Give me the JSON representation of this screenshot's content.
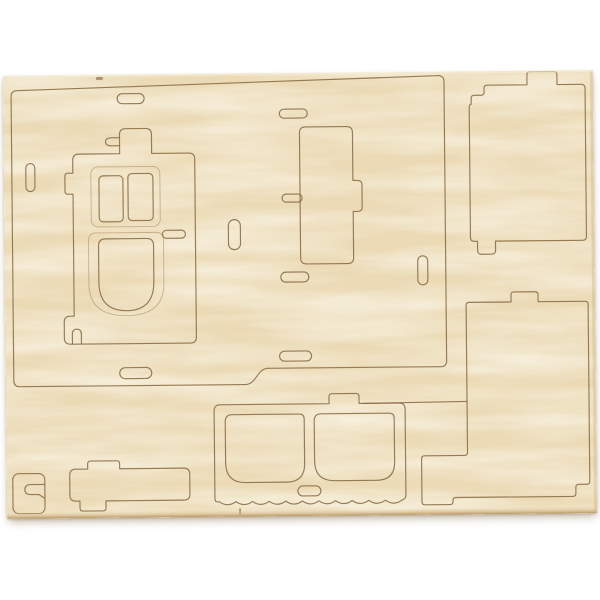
{
  "meta": {
    "description": "Product photo of a light birch plywood laser-cut sheet for a 3D wooden model kit. The sheet lies on a white background, slightly rotated, with pre-cut push-out pieces still in place: a large side-wall panel containing a door piece with two small windows and an arched lower window, a vertical support piece, two large rectangular wall panels with interlocking tabs on the right, a front panel with two rounded windows and a scalloped lower edge, and small connector pieces at the bottom left. Numerous pill-shaped slots are cut through the panels.",
    "object_count_pieces": 9
  },
  "palette": {
    "background": "#ffffff",
    "wood_base": "#ebdab5",
    "wood_light": "#f7eed7",
    "wood_dark": "#dfc89e",
    "cut_line": "#8a6b42",
    "engrave_line": "#a88d60",
    "sheet_edge_dark": "#b5905c",
    "sheet_edge_soft": "#d3b789",
    "shadow": "rgba(140,118,85,0.55)"
  },
  "sheet": {
    "x": 5,
    "y": 73,
    "width": 590,
    "height": 443,
    "rotation_deg": -0.55,
    "shapes": [
      {
        "name": "cut-left-wall-panel",
        "type": "path",
        "cls": "cut",
        "d": "M14,311 Q8,311 8,305 L8,21 Q8,15 14,15 L433,4 Q441,3 441,10 L441,289 Q441,295 435,295 L262,295 C252,295 250,311 240,311 Z"
      },
      {
        "name": "cut-door-piece",
        "type": "path",
        "cls": "cut",
        "d": "M75,79 L116,79 L116,60 Q116,54 122,54 L142,54 Q148,54 148,60 L148,79 L185,79 Q191,79 191,85 L191,263 Q191,269 185,269 L65,269 Q59,269 59,263 L59,247 Q59,241 65,241 L69,241 L69,119 L64,119 Q61,119 61,116 L61,101 Q61,98 64,98 L69,98 L69,85 Q69,79 75,79 Z"
      },
      {
        "name": "cut-door-tab-slot",
        "type": "path",
        "cls": "cut",
        "d": "M116,63 L108,63 Q102,63 102,67 Q102,71 108,71 L116,71"
      },
      {
        "name": "cut-door-foot-notch",
        "type": "path",
        "cls": "cut",
        "d": "M67,269 L67,259 Q67,254 71.5,254 Q76,254 76,259 L76,269"
      },
      {
        "name": "engrave-door-window-frame",
        "type": "rect",
        "cls": "engrave",
        "x": 87,
        "y": 92,
        "w": 69,
        "h": 60,
        "rx": 7
      },
      {
        "name": "cut-door-window-left",
        "type": "rect",
        "cls": "cut",
        "x": 95,
        "y": 101,
        "w": 24,
        "h": 46,
        "rx": 4
      },
      {
        "name": "cut-door-window-right",
        "type": "rect",
        "cls": "cut",
        "x": 124,
        "y": 99,
        "w": 25,
        "h": 47,
        "rx": 4
      },
      {
        "name": "engrave-door-arch-frame",
        "type": "path",
        "cls": "engrave",
        "d": "M92,158 L151,158 Q159,158 159,166 L159,209 Q159,241 121.5,241 Q84,241 84,209 L84,166 Q84,158 92,158 Z"
      },
      {
        "name": "cut-door-arch-window",
        "type": "path",
        "cls": "cut",
        "d": "M101,164 L142,164 Q149,164 149,171 L149,207 Q149,236 121.5,236 Q94,236 94,207 L94,171 Q94,164 101,164 Z"
      },
      {
        "name": "cut-door-handle-slot",
        "type": "rect",
        "cls": "cut",
        "x": 158,
        "y": 156,
        "w": 23,
        "h": 8,
        "rx": 4
      },
      {
        "name": "cut-support-piece",
        "type": "path",
        "cls": "cut",
        "d": "M302,54 L343,54 Q349,54 349,60 L349,108 L353,108 Q358,108 358,112 L358,135 Q358,139 353,139 L349,139 L349,185 Q349,191 343,191 L302,191 Q296,191 296,185 L296,60 Q296,54 302,54 Z"
      },
      {
        "name": "cut-slot-top-left",
        "type": "rect",
        "cls": "cut",
        "x": 114,
        "y": 19,
        "w": 27,
        "h": 10,
        "rx": 5
      },
      {
        "name": "cut-slot-top-middle",
        "type": "rect",
        "cls": "cut",
        "x": 276,
        "y": 36,
        "w": 28,
        "h": 9,
        "rx": 4.5
      },
      {
        "name": "cut-slot-left-vertical",
        "type": "rect",
        "cls": "cut",
        "x": 22,
        "y": 88,
        "w": 9,
        "h": 28,
        "rx": 4.5
      },
      {
        "name": "cut-slot-mid-vertical",
        "type": "rect",
        "cls": "cut",
        "x": 224,
        "y": 146,
        "w": 12,
        "h": 30,
        "rx": 6
      },
      {
        "name": "cut-slot-support-notch",
        "type": "rect",
        "cls": "cut",
        "x": 278,
        "y": 121,
        "w": 20,
        "h": 8,
        "rx": 4
      },
      {
        "name": "cut-slot-below-support",
        "type": "rect",
        "cls": "cut",
        "x": 276,
        "y": 199,
        "w": 28,
        "h": 10,
        "rx": 5
      },
      {
        "name": "cut-slot-right-vertical",
        "type": "rect",
        "cls": "cut",
        "x": 413,
        "y": 184,
        "w": 10,
        "h": 29,
        "rx": 5
      },
      {
        "name": "cut-slot-bottom-middle",
        "type": "rect",
        "cls": "cut",
        "x": 274,
        "y": 278,
        "w": 32,
        "h": 10,
        "rx": 5
      },
      {
        "name": "cut-slot-bottom-left",
        "type": "rect",
        "cls": "cut",
        "x": 114,
        "y": 293,
        "w": 32,
        "h": 11,
        "rx": 5.5
      },
      {
        "name": "cut-right-top-panel",
        "type": "path",
        "cls": "cut",
        "d": "M466,36 L466,166 Q466,170 470,170 L473,170 L473,179 Q473,183 477,183 L487,183 Q491,183 491,179 L491,170 L578,170 Q582,170 582,166 L582,18 Q582,14 578,14 L554,14 L554,4 Q554,1 551,1 L527,1 Q524,1 524,4 L524,14 L484,14 Q481,14 481,17 L481,21 Q481,24 478,24 L471,24 Q468,24 468,27 L468,33 Q466,33 466,36 Z"
      },
      {
        "name": "cut-right-bottom-panel",
        "type": "path",
        "cls": "cut",
        "d": "M461,234 Q461,231 464,231 L506,231 L506,224 Q506,221 509,221 L530,221 Q533,221 533,224 L533,231 L580,231 Q583,231 583,234 L583,411 Q583,414 580,414 L572,414 Q569,414 569,417 L569,423 Q569,426 566,426 L449,426 Q446,426 446,429 L446,430 Q446,433 443,433 L418,433 Q415,433 415,430 L415,387 Q415,384 418,384 L458,384 Q461,384 461,381 Z"
      },
      {
        "name": "cut-front-panel",
        "type": "path",
        "cls": "cut",
        "d": "M208,424 L208,337 Q208,331 214,331 L323,331 L323,324 Q323,321 326,321 L350,321 Q353,321 353,324 L353,331 L393,331 Q399,331 399,337 L399,423 Q399,427 395,428 q-8.3,6 -16.6,0 q-8.3,6 -16.6,0 q-8.3,6 -16.6,0 q-8.3,6 -16.6,0 q-8.3,6 -16.6,0 q-8.3,6 -16.6,0 q-8.3,6 -16.6,0 q-8.3,6 -16.6,0 q-8.3,6 -16.6,0 q-8.3,6 -16.6,0 q-8.3,6 -16.6,0 L210,428 Q208,428 208,424 Z"
      },
      {
        "name": "cut-front-panel-top-line",
        "type": "path",
        "cls": "cut",
        "d": "M357,331 L461,330"
      },
      {
        "name": "cut-front-window-left",
        "type": "path",
        "cls": "cut",
        "d": "M226,341 L293,341 Q298,341 298,346 L298,391 Q298,409 280,409 L239,409 Q219,409 219,389 L219,348 Q219,341 226,341 Z"
      },
      {
        "name": "cut-front-window-right",
        "type": "path",
        "cls": "cut",
        "d": "M315,341 L383,341 Q388,341 388,346 L388,390 Q388,408 370,408 L328,408 Q308,408 308,388 L308,348 Q308,341 315,341 Z"
      },
      {
        "name": "cut-front-panel-slot",
        "type": "rect",
        "cls": "cut",
        "x": 291,
        "y": 413,
        "w": 23,
        "h": 10,
        "rx": 5
      },
      {
        "name": "cut-corner-piece",
        "type": "rect",
        "cls": "cut",
        "x": 6,
        "y": 398,
        "w": 32,
        "h": 40,
        "rx": 6
      },
      {
        "name": "cut-corner-hook-slot",
        "type": "path",
        "cls": "cut",
        "d": "M38,409 L24,409 Q18,409 18,414 Q18,419 24,419 L32,419 L38,423"
      },
      {
        "name": "cut-connector-bar",
        "type": "path",
        "cls": "cut",
        "d": "M63,400 Q63,394 69,394 L81,394 L81,389 Q81,386 84,386 L110,386 Q113,386 113,389 L113,394 L177,394 Q183,394 183,400 L183,420 Q183,426 177,426 L99,426 L99,433 Q99,436 96,436 L76,436 Q73,436 73,433 L73,426 L69,426 Q63,426 63,420 Z"
      },
      {
        "name": "mark-bottom-edge-tick",
        "type": "path",
        "cls": "mark",
        "d": "M233,435 L233,441"
      },
      {
        "name": "mark-top-edge-notch",
        "type": "rectfill",
        "cls": "markfill",
        "x": 93,
        "y": 2,
        "w": 7,
        "h": 3,
        "rx": 1
      }
    ]
  }
}
